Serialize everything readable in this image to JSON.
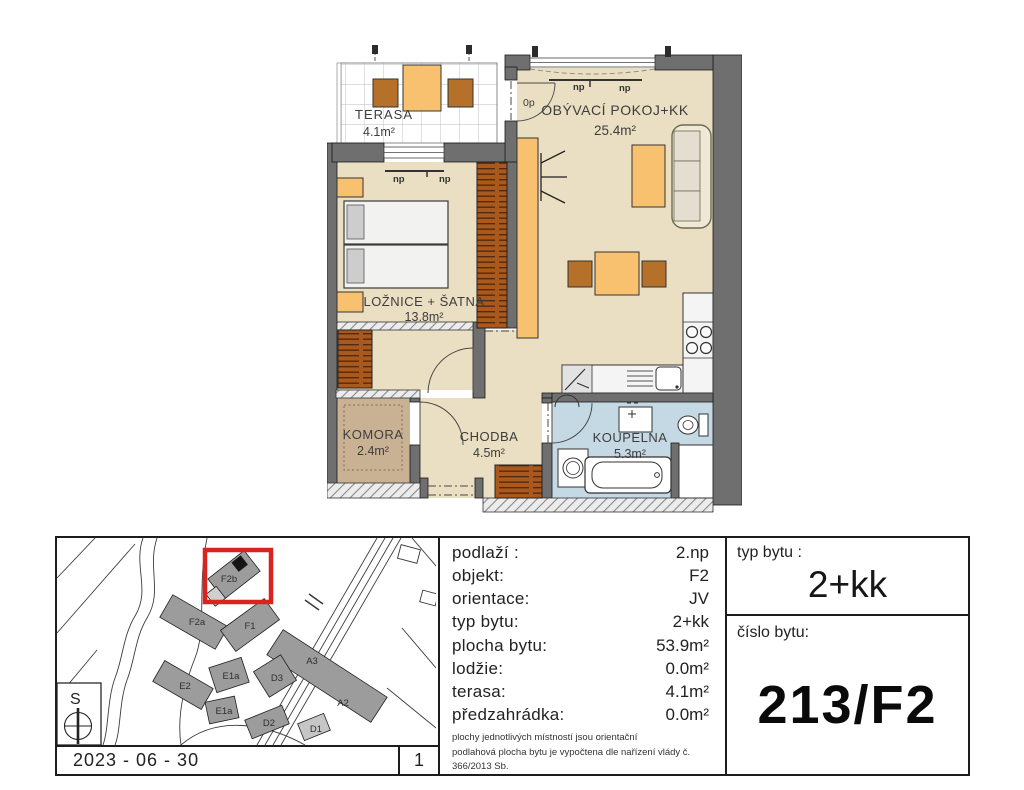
{
  "floor_plan": {
    "rooms": [
      {
        "name": "TERASA",
        "area": "4.1m²"
      },
      {
        "name": "OBÝVACÍ POKOJ+KK",
        "area": "25.4m²"
      },
      {
        "name": "LOŽNICE + ŠATNA",
        "area": "13.8m²"
      },
      {
        "name": "KOMORA",
        "area": "2.4m²"
      },
      {
        "name": "CHODBA",
        "area": "4.5m²"
      },
      {
        "name": "KOUPELNA",
        "area": "5.3m²"
      }
    ],
    "annotations": {
      "np": "np",
      "op": "0p"
    }
  },
  "site_map": {
    "buildings": [
      "F2b",
      "F2a",
      "F1",
      "E1a",
      "E1a",
      "E2",
      "D3",
      "D2",
      "D1",
      "A3",
      "A2"
    ],
    "highlighted_building": "F2b",
    "compass_label": "S",
    "date": "2023 - 06 - 30",
    "sheet_number": "1",
    "highlight_color": "#d8231f"
  },
  "info_table": {
    "rows": [
      {
        "label": "podlaží :",
        "value": "2.np"
      },
      {
        "label": "objekt:",
        "value": "F2"
      },
      {
        "label": "orientace:",
        "value": "JV"
      },
      {
        "label": "typ bytu:",
        "value": "2+kk"
      },
      {
        "label": "plocha bytu:",
        "value": "53.9m²"
      },
      {
        "label": "lodžie:",
        "value": "0.0m²"
      },
      {
        "label": "terasa:",
        "value": "4.1m²"
      },
      {
        "label": "předzahrádka:",
        "value": "0.0m²"
      }
    ],
    "notes": [
      "plochy jednotlivých místností jsou orientační",
      "podlahová plocha bytu je vypočtena dle nařízení vlády č. 366/2013 Sb."
    ]
  },
  "summary": {
    "typ_bytu_label": "typ bytu :",
    "typ_bytu_value": "2+kk",
    "cislo_bytu_label": "číslo bytu:",
    "cislo_bytu_value": "213/F2"
  },
  "colors": {
    "floor": "#eadfc2",
    "storage_floor": "#c9b294",
    "bath_floor": "#c5d9e4",
    "wall": "#6f6f6f",
    "furniture_orange": "#f7c170",
    "wood_brown": "#a9591d",
    "highlight_red": "#d8231f"
  }
}
